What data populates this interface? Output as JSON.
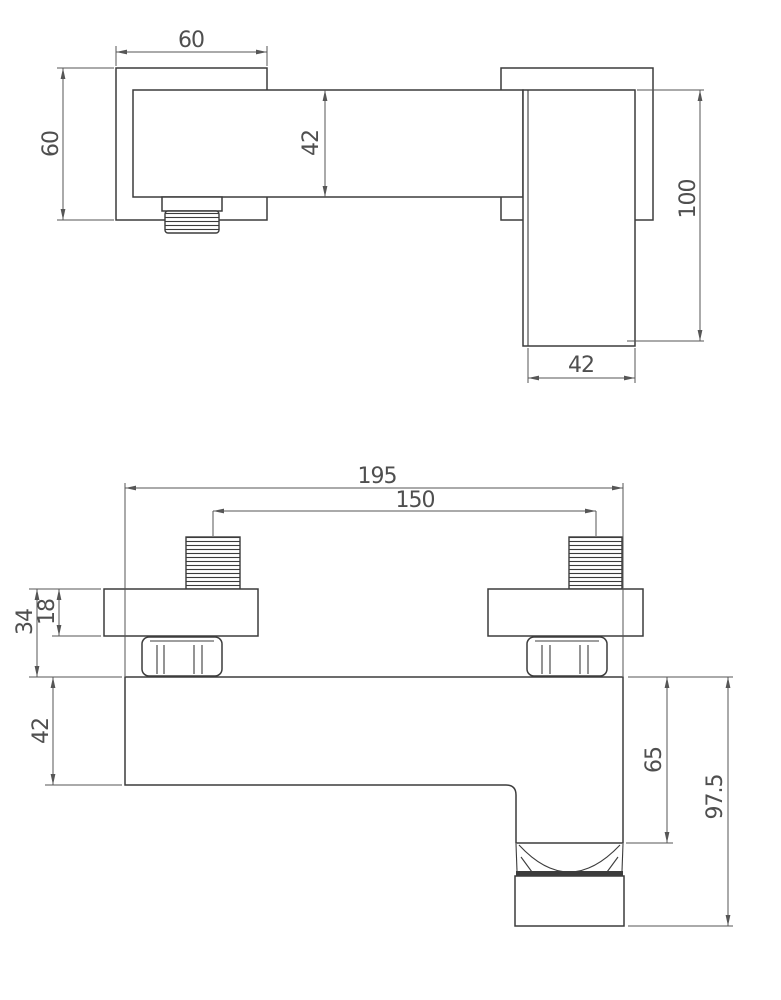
{
  "colors": {
    "background": "#ffffff",
    "object_line": "#3c3c3c",
    "dimension_line": "#565656",
    "text": "#4f4f4f"
  },
  "side_view": {
    "dimensions": {
      "plate_width": "60",
      "plate_height": "60",
      "bar_height": "42",
      "handle_height": "100",
      "handle_width": "42"
    }
  },
  "front_view": {
    "dimensions": {
      "overall_width": "195",
      "inlet_spacing": "150",
      "wall_offset": "34",
      "plate_thickness": "18",
      "body_height": "42",
      "spout_offset": "65",
      "overall_height": "97.5"
    }
  }
}
